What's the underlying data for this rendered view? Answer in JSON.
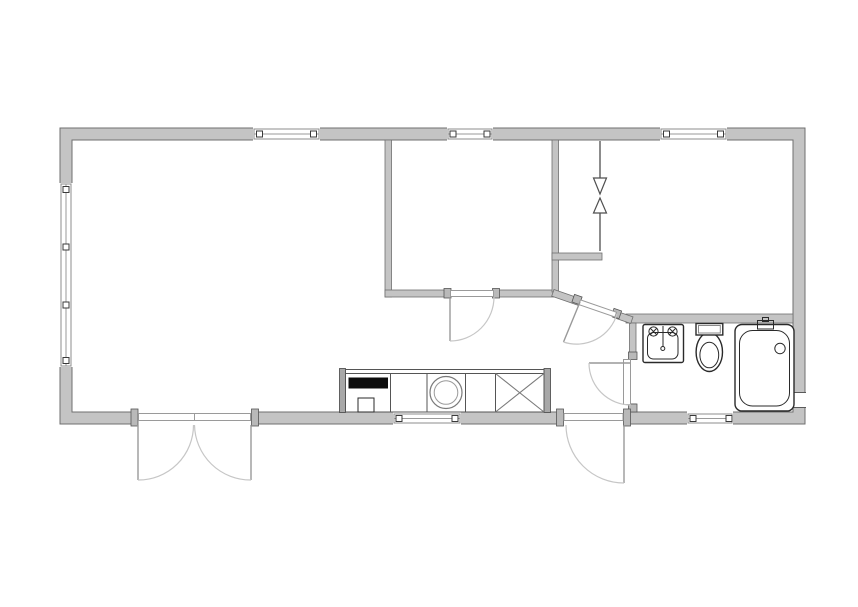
{
  "plan": {
    "background": "#ffffff",
    "summary": {
      "window_openings": 6,
      "door_openings": 5,
      "rooms": 5
    }
  },
  "colors": {
    "wall_fill": "#c4c4c4",
    "wall_edge": "#6f6f6f",
    "stove_fill": "#0d0d0d",
    "fixture_outline": "#2a2a2a",
    "door_swing": "#c6c6c6",
    "door_leaf": "#999999",
    "window_tick": "#3a3a3a"
  },
  "fixtures": {
    "kitchen": [
      "stove",
      "base-cabinet",
      "washing-machine",
      "base-cabinet",
      "appliance-space-x"
    ],
    "bathroom": [
      "wash-basin",
      "toilet",
      "bathtub"
    ],
    "doors": [
      "double-entry-door",
      "bedroom-door",
      "angled-hall-door",
      "bathroom-door",
      "back-door"
    ],
    "windows": [
      "left-triple-window",
      "top-window-1",
      "top-window-2",
      "top-window-3",
      "kitchen-window",
      "bathroom-window"
    ],
    "annotations": [
      "down-arrow",
      "up-arrow"
    ]
  }
}
